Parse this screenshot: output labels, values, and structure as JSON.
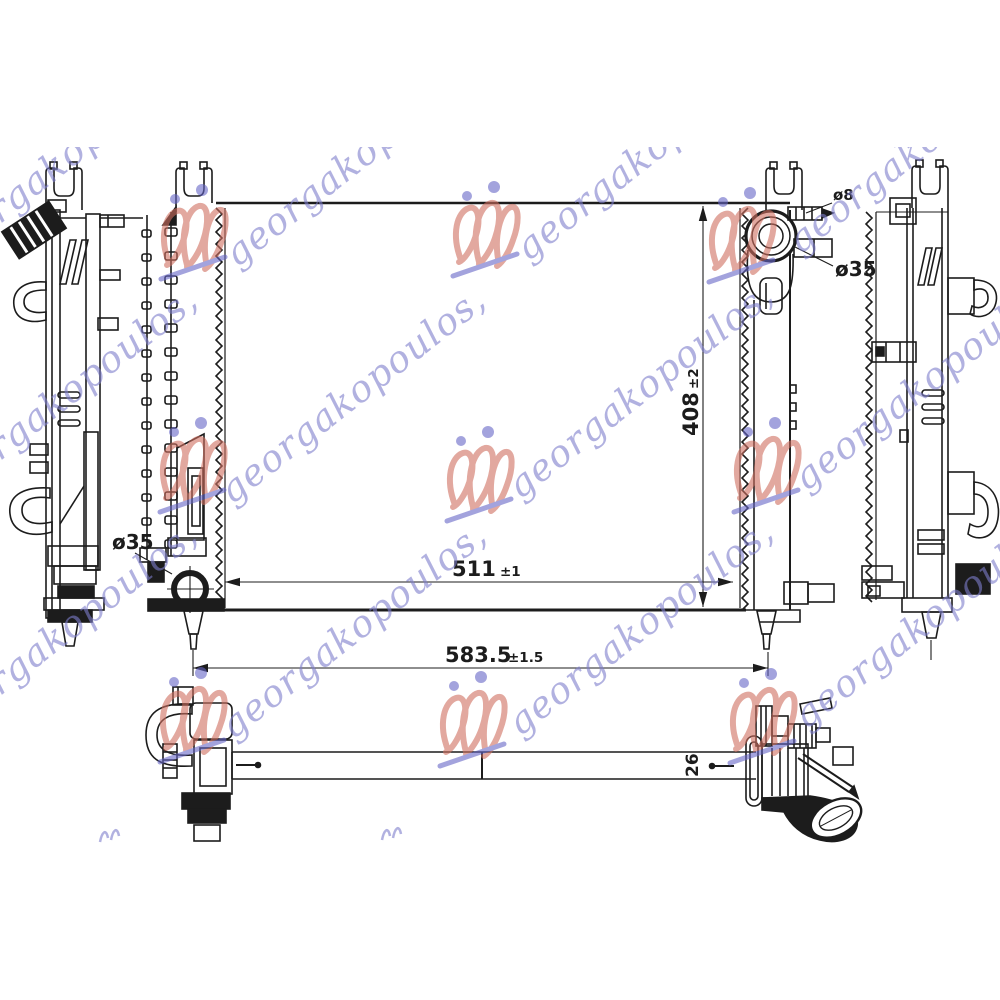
{
  "page": {
    "background": "#ffffff",
    "description": "Technical line drawing of an automotive radiator with four orthographic views and dimension callouts"
  },
  "watermark": {
    "text": "georgakopoulos,",
    "text_color": "#7d7dcb",
    "logo_red": "#cf6f5f",
    "logo_blue": "#6666c6"
  },
  "drawing": {
    "line_color": "#1c1c1c",
    "dimensions": {
      "core_width": {
        "value": "511",
        "tol": "±1"
      },
      "overall_width": {
        "value": "583.5",
        "tol": "±1.5"
      },
      "core_height": {
        "value": "408",
        "tol": "±2"
      },
      "thickness": {
        "value": "26"
      },
      "inlet_diameter": "ø35",
      "bleed_pipe_diameter": "ø8",
      "outlet_diameter": "ø35"
    }
  }
}
